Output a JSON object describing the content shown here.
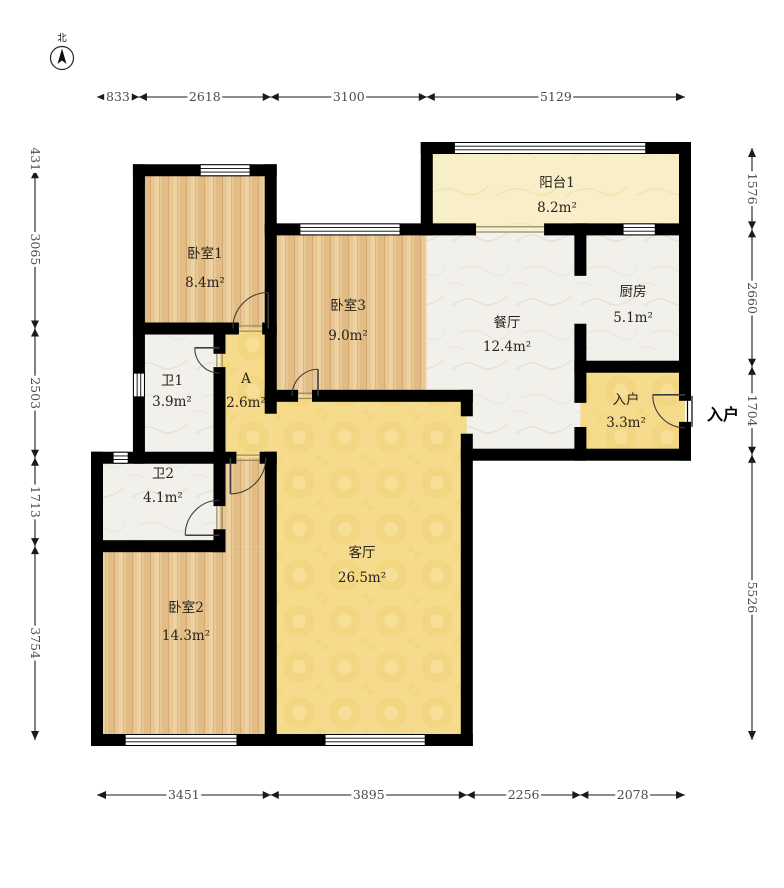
{
  "compass": {
    "label": "北"
  },
  "entry_annotation": {
    "label": "入户"
  },
  "colors": {
    "wall": "#000000",
    "dim_line": "#1a1a1a",
    "dim_text": "#4c4c4c",
    "room_text": "#26221c",
    "sill": "#9b8a60",
    "door": "#3d3d3d",
    "floor_wood": "#e8c795",
    "floor_marble": "#f1f0ea",
    "floor_yellow": "#f5db8b",
    "floor_cream": "#f8efc9"
  },
  "plan": {
    "scale": {
      "x0": 97,
      "y0": 148,
      "kx": 0.050342,
      "ky": 0.051632,
      "wall_px": 12
    },
    "rooms": [
      {
        "id": "balcony1",
        "name": "阳台1",
        "area": "8.2m²",
        "floor": "cream",
        "rects": [
          [
            6551,
            0,
            11680,
            1576
          ]
        ],
        "label": [
          9138,
          755,
          1240
        ]
      },
      {
        "id": "bedroom1",
        "name": "卧室1",
        "area": "8.4m²",
        "floor": "wood",
        "rects": [
          [
            833,
            431,
            3451,
            3496
          ]
        ],
        "label": [
          2145,
          2131,
          2692
        ]
      },
      {
        "id": "bedroom3",
        "name": "卧室3",
        "area": "9.0m²",
        "floor": "wood",
        "rects": [
          [
            3451,
            1576,
            6551,
            4800
          ]
        ],
        "label": [
          4987,
          3138,
          3719
        ]
      },
      {
        "id": "kitchen",
        "name": "厨房",
        "area": "5.1m²",
        "floor": "marble",
        "rects": [
          [
            9602,
            1576,
            11680,
            4236
          ]
        ],
        "label": [
          10648,
          2867,
          3370
        ]
      },
      {
        "id": "dining",
        "name": "餐厅",
        "area": "12.4m²",
        "floor": "marble",
        "rects": [
          [
            6551,
            1576,
            9602,
            4800
          ],
          [
            7346,
            4800,
            9602,
            5940
          ]
        ],
        "label": [
          8145,
          3467,
          3932
        ]
      },
      {
        "id": "entry",
        "name": "入户",
        "area": "3.3m²",
        "floor": "yellow",
        "rects": [
          [
            9602,
            4236,
            11680,
            5940
          ]
        ],
        "label": [
          10509,
          4959,
          5404
        ]
      },
      {
        "id": "bath1",
        "name": "卫1",
        "area": "3.9m²",
        "floor": "marble",
        "rects": [
          [
            833,
            3496,
            2433,
            5999
          ]
        ],
        "label": [
          1490,
          4590,
          4997
        ]
      },
      {
        "id": "hall-a",
        "name": "A",
        "area": "2.6m²",
        "floor": "yellow",
        "rects": [
          [
            2433,
            3496,
            3451,
            5999
          ]
        ],
        "label": [
          2960,
          4552,
          5017
        ]
      },
      {
        "id": "bath2",
        "name": "卫2",
        "area": "4.1m²",
        "floor": "marble",
        "rects": [
          [
            0,
            5999,
            2433,
            7712
          ]
        ],
        "label": [
          1311,
          6392,
          6857
        ]
      },
      {
        "id": "bedroom2",
        "name": "卧室2",
        "area": "14.3m²",
        "floor": "wood",
        "rects": [
          [
            0,
            7712,
            3451,
            11466
          ],
          [
            2433,
            5999,
            3451,
            7712
          ]
        ],
        "label": [
          1768,
          8987,
          9529
        ]
      },
      {
        "id": "living",
        "name": "客厅",
        "area": "26.5m²",
        "floor": "yellow",
        "rects": [
          [
            3451,
            4800,
            7346,
            11466
          ]
        ],
        "label": [
          5264,
          7922,
          8406
        ]
      }
    ],
    "walls": {
      "h": [
        {
          "y": 431,
          "spans": [
            [
              833,
              3451
            ]
          ]
        },
        {
          "y": 0,
          "spans": [
            [
              6551,
              11680
            ]
          ]
        },
        {
          "y": 1576,
          "spans": [
            [
              3451,
              7410
            ],
            [
              9000,
              11680
            ]
          ]
        },
        {
          "y": 3496,
          "spans": [
            [
              833,
              2700
            ],
            [
              3400,
              3451
            ]
          ]
        },
        {
          "y": 4236,
          "spans": [
            [
              9602,
              11680
            ]
          ]
        },
        {
          "y": 4800,
          "spans": [
            [
              3451,
              3875
            ],
            [
              4390,
              7346
            ]
          ]
        },
        {
          "y": 5940,
          "spans": [
            [
              7346,
              11680
            ]
          ]
        },
        {
          "y": 5999,
          "spans": [
            [
              0,
              2650
            ],
            [
              3350,
              3451
            ]
          ]
        },
        {
          "y": 7712,
          "spans": [
            [
              0,
              2433
            ]
          ]
        },
        {
          "y": 11466,
          "spans": [
            [
              0,
              7346
            ]
          ]
        }
      ],
      "v": [
        {
          "x": 833,
          "spans": [
            [
              431,
              5999
            ]
          ]
        },
        {
          "x": 3451,
          "spans": [
            [
              431,
              5030
            ],
            [
              5999,
              11466
            ]
          ]
        },
        {
          "x": 6551,
          "spans": [
            [
              0,
              1576
            ]
          ]
        },
        {
          "x": 11680,
          "spans": [
            [
              0,
              4780
            ],
            [
              5420,
              5940
            ]
          ]
        },
        {
          "x": 0,
          "spans": [
            [
              5999,
              11466
            ]
          ]
        },
        {
          "x": 7346,
          "spans": [
            [
              4800,
              5080
            ],
            [
              5650,
              11466
            ]
          ]
        },
        {
          "x": 9602,
          "spans": [
            [
              1576,
              2360
            ],
            [
              3520,
              4820
            ],
            [
              5520,
              5940
            ]
          ]
        },
        {
          "x": 2433,
          "spans": [
            [
              3496,
              3870
            ],
            [
              4360,
              6820
            ],
            [
              7500,
              7712
            ]
          ]
        }
      ]
    },
    "windows": [
      {
        "o": "h",
        "at": 431,
        "s": 2050,
        "e": 3040
      },
      {
        "o": "h",
        "at": 1576,
        "s": 4030,
        "e": 6020
      },
      {
        "o": "h",
        "at": 0,
        "s": 7100,
        "e": 10900
      },
      {
        "o": "h",
        "at": 1576,
        "s": 10450,
        "e": 11090
      },
      {
        "o": "v",
        "at": 833,
        "s": 4360,
        "e": 4820
      },
      {
        "o": "h",
        "at": 5999,
        "s": 320,
        "e": 620
      },
      {
        "o": "h",
        "at": 11466,
        "s": 560,
        "e": 2780
      },
      {
        "o": "h",
        "at": 11466,
        "s": 4530,
        "e": 6520
      }
    ],
    "sills": [
      {
        "o": "h",
        "at": 3496,
        "s": 2700,
        "e": 3400
      },
      {
        "o": "h",
        "at": 4800,
        "s": 3875,
        "e": 4390
      },
      {
        "o": "h",
        "at": 5999,
        "s": 2650,
        "e": 3350
      },
      {
        "o": "v",
        "at": 2433,
        "s": 3870,
        "e": 4360
      },
      {
        "o": "v",
        "at": 2433,
        "s": 6820,
        "e": 7500
      },
      {
        "o": "h",
        "at": 1576,
        "s": 7410,
        "e": 9000
      }
    ],
    "doors": [
      {
        "name": "bedroom1-door",
        "hinge": [
          3400,
          3496
        ],
        "tip": [
          3400,
          2796
        ],
        "jamb": [
          2700,
          3496
        ],
        "r": 700,
        "sweep": 0
      },
      {
        "name": "bedroom3-door",
        "hinge": [
          4390,
          4800
        ],
        "tip": [
          4390,
          4285
        ],
        "jamb": [
          3875,
          4800
        ],
        "r": 515,
        "sweep": 0
      },
      {
        "name": "bath1-door",
        "hinge": [
          2433,
          3870
        ],
        "tip": [
          1943,
          3870
        ],
        "jamb": [
          2433,
          4360
        ],
        "r": 490,
        "sweep": 0
      },
      {
        "name": "bedroom2-door",
        "hinge": [
          2650,
          5999
        ],
        "tip": [
          2650,
          6699
        ],
        "jamb": [
          3350,
          5999
        ],
        "r": 700,
        "sweep": 0
      },
      {
        "name": "bath2-door",
        "hinge": [
          2433,
          7500
        ],
        "tip": [
          1753,
          7500
        ],
        "jamb": [
          2433,
          6820
        ],
        "r": 680,
        "sweep": 1
      },
      {
        "name": "entry-door",
        "hinge": [
          11680,
          4780
        ],
        "tip": [
          11040,
          4780
        ],
        "jamb": [
          11680,
          5420
        ],
        "r": 640,
        "sweep": 0
      }
    ],
    "entry_leaf": {
      "x": 11680,
      "y1": 4780,
      "y2": 5420
    },
    "dims": {
      "top": {
        "axis": "x",
        "pos": 97,
        "ticks": [
          0,
          833,
          3451,
          6551,
          11680
        ],
        "labels": [
          "833",
          "2618",
          "3100",
          "5129"
        ]
      },
      "bottom": {
        "axis": "x",
        "pos": 795,
        "ticks": [
          0,
          3451,
          7346,
          9602,
          11680
        ],
        "labels": [
          "3451",
          "3895",
          "2256",
          "2078"
        ]
      },
      "left": {
        "axis": "y",
        "pos": 35,
        "ticks": [
          0,
          431,
          3496,
          5999,
          7712,
          11466
        ],
        "labels": [
          "431",
          "3065",
          "2503",
          "1713",
          "3754"
        ]
      },
      "right": {
        "axis": "y",
        "pos": 752,
        "ticks": [
          0,
          1576,
          4236,
          5940,
          11466
        ],
        "labels": [
          "1576",
          "2660",
          "1704",
          "5526"
        ]
      }
    },
    "compass_pos": {
      "cx": 62,
      "cy": 58,
      "r": 11.5,
      "label_y": 41
    },
    "entry_label_pos": {
      "x": 723,
      "y": 420
    }
  }
}
